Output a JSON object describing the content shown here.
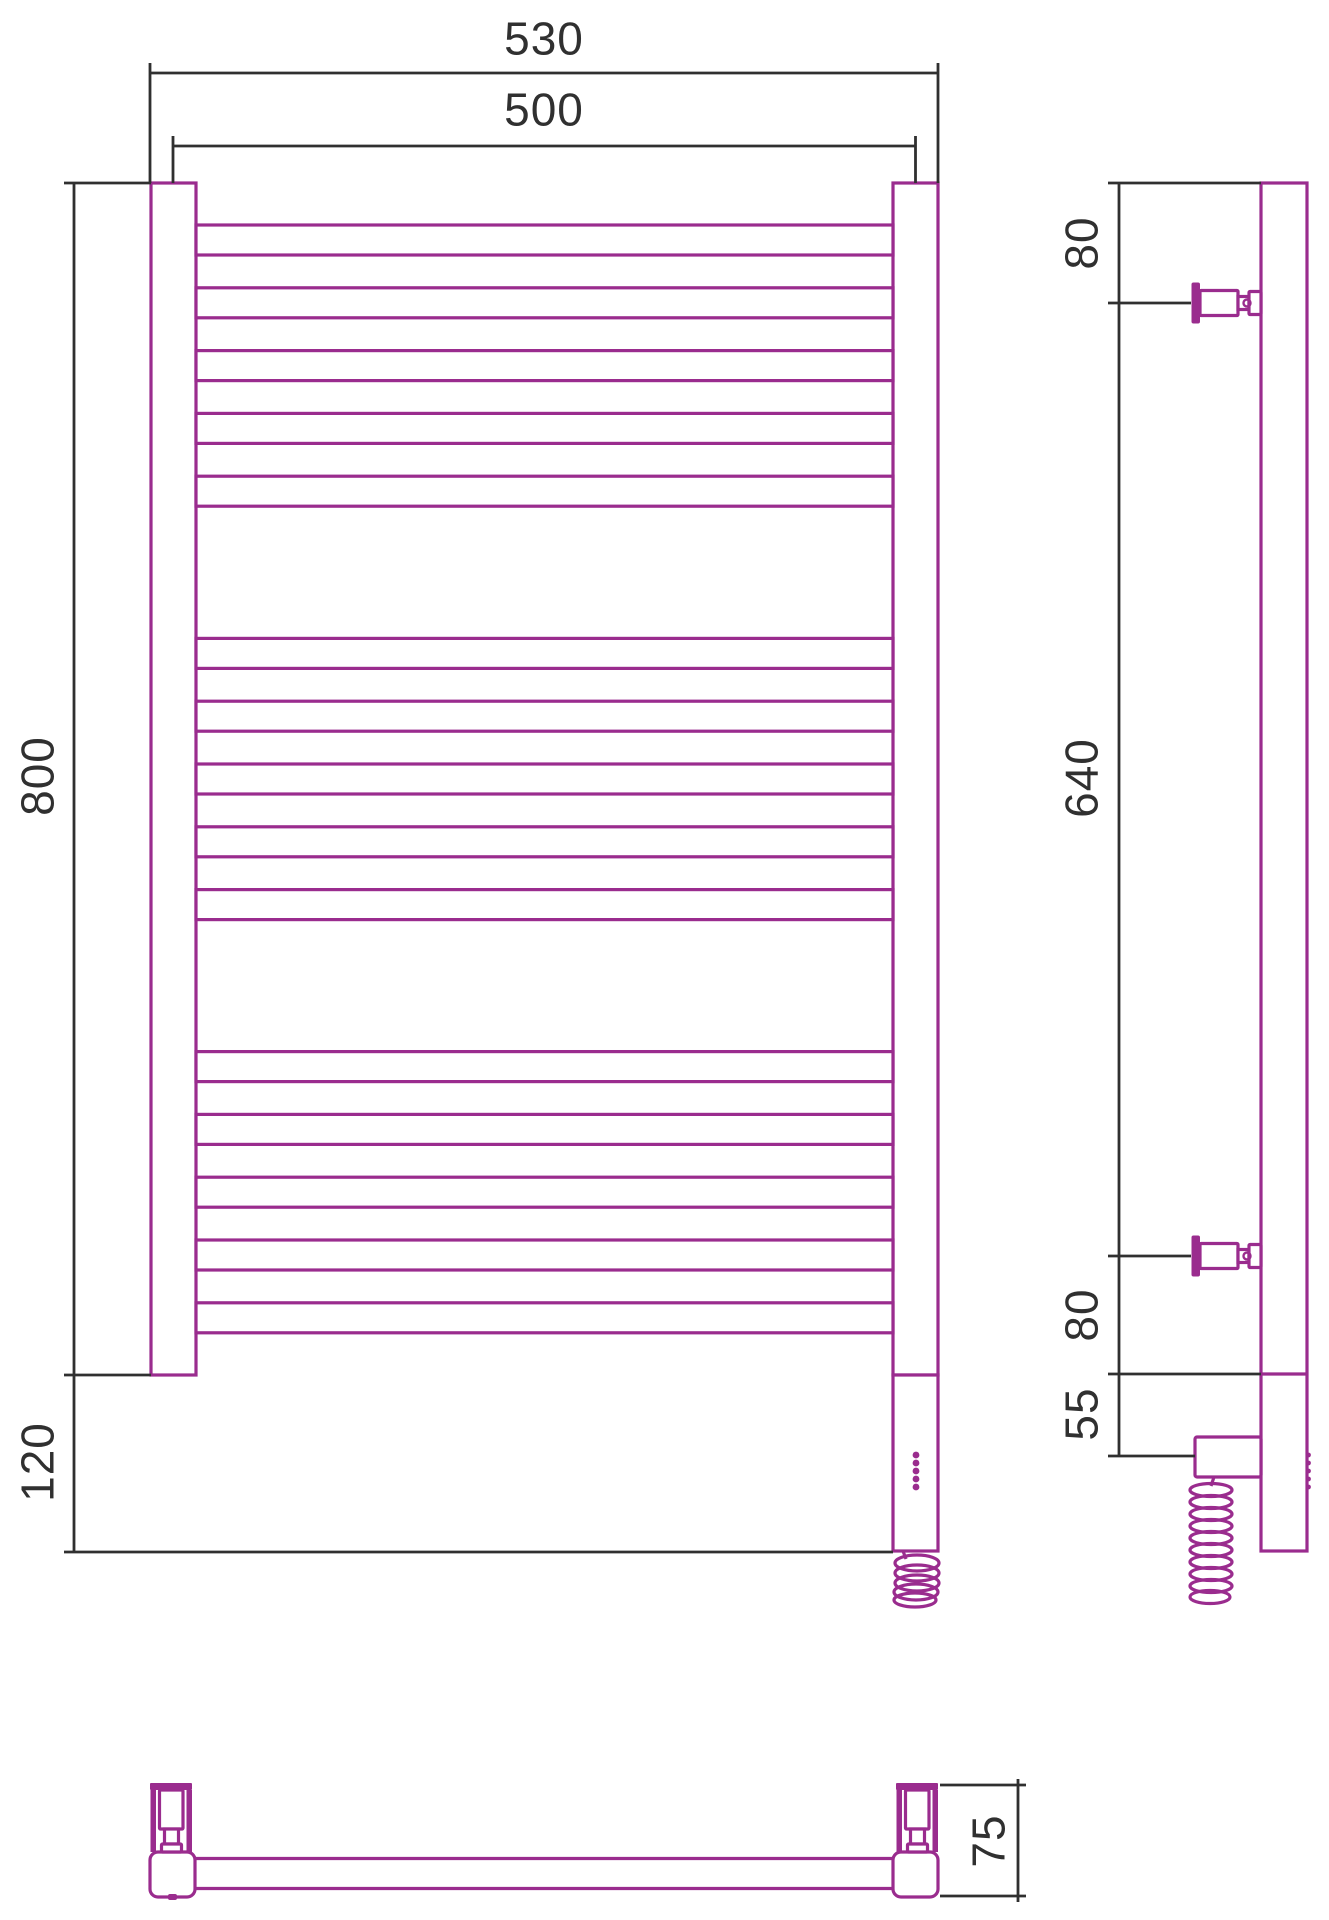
{
  "drawing": {
    "canvas": {
      "width": 1329,
      "height": 1920,
      "background": "#ffffff"
    },
    "colors": {
      "product": "#9A2C8E",
      "dimension": "#303030",
      "fill": "#ffffff"
    },
    "stroke_widths": {
      "product": 3.2,
      "thin": 2.8,
      "dimension": 2.8
    },
    "font": {
      "size": 46,
      "color": "#303030"
    },
    "crossbars": {
      "x": 196,
      "w": 697,
      "h": 30,
      "tops": [
        225,
        287.8,
        350.6,
        413.4,
        476.2,
        638.4,
        701.2,
        764,
        826.8,
        889.6,
        1051.6,
        1114.4,
        1177.2,
        1240,
        1302.8
      ]
    },
    "outlined_rects": [
      {
        "name": "front-left-rail",
        "x": 151,
        "y": 183,
        "w": 45,
        "h": 1192,
        "rx": 0
      },
      {
        "name": "front-right-rail",
        "x": 893,
        "y": 183,
        "w": 45,
        "h": 1192,
        "rx": 0
      },
      {
        "name": "front-heater-housing",
        "x": 893,
        "y": 1375,
        "w": 45,
        "h": 176,
        "rx": 0
      },
      {
        "name": "side-tube",
        "x": 1261,
        "y": 183,
        "w": 46,
        "h": 1368,
        "rx": 0
      },
      {
        "name": "side-electric-box",
        "x": 1195,
        "y": 1437,
        "w": 66,
        "h": 40,
        "rx": 2
      },
      {
        "name": "side-bracket-top-housing",
        "x": 1200,
        "y": 290.5,
        "w": 38,
        "h": 25,
        "rx": 1
      },
      {
        "name": "side-bracket-top-neck",
        "x": 1238,
        "y": 296.5,
        "w": 11,
        "h": 13,
        "rx": 0
      },
      {
        "name": "side-bracket-top-cap",
        "x": 1249,
        "y": 291.5,
        "w": 12,
        "h": 23,
        "rx": 1
      },
      {
        "name": "side-bracket-bottom-housing",
        "x": 1200,
        "y": 1243.5,
        "w": 38,
        "h": 25,
        "rx": 1
      },
      {
        "name": "side-bracket-bottom-neck",
        "x": 1238,
        "y": 1249.5,
        "w": 11,
        "h": 13,
        "rx": 0
      },
      {
        "name": "side-bracket-bottom-cap",
        "x": 1249,
        "y": 1244.5,
        "w": 12,
        "h": 23,
        "rx": 1
      },
      {
        "name": "bottom-left-corner-block",
        "x": 150,
        "y": 1852,
        "w": 45,
        "h": 45,
        "rx": 8
      },
      {
        "name": "bottom-right-corner-block",
        "x": 893,
        "y": 1852,
        "w": 45,
        "h": 45,
        "rx": 8
      },
      {
        "name": "bottom-left-bracket-cylinder",
        "x": 159.5,
        "y": 1790,
        "w": 23.5,
        "h": 39,
        "rx": 1
      },
      {
        "name": "bottom-left-bracket-stem",
        "x": 164.5,
        "y": 1829,
        "w": 14,
        "h": 15,
        "rx": 0
      },
      {
        "name": "bottom-left-bracket-flange",
        "x": 161.5,
        "y": 1844,
        "w": 20,
        "h": 8,
        "rx": 1
      },
      {
        "name": "bottom-right-bracket-cylinder",
        "x": 905.5,
        "y": 1790,
        "w": 23.5,
        "h": 39,
        "rx": 1
      },
      {
        "name": "bottom-right-bracket-stem",
        "x": 910.5,
        "y": 1829,
        "w": 14,
        "h": 15,
        "rx": 0
      },
      {
        "name": "bottom-right-bracket-flange",
        "x": 907.5,
        "y": 1844,
        "w": 20,
        "h": 8,
        "rx": 1
      }
    ],
    "filled_rects": [
      {
        "name": "side-bracket-top-wall-flange",
        "x": 1191.5,
        "y": 282.5,
        "w": 8.5,
        "h": 41,
        "rx": 2
      },
      {
        "name": "side-bracket-bottom-wall-flange",
        "x": 1191.5,
        "y": 1235.5,
        "w": 8.5,
        "h": 41,
        "rx": 2
      },
      {
        "name": "bottom-left-wall-plate",
        "x": 150,
        "y": 1783,
        "w": 42,
        "h": 7,
        "rx": 1
      },
      {
        "name": "bottom-right-wall-plate",
        "x": 896,
        "y": 1783,
        "w": 42,
        "h": 7,
        "rx": 1
      },
      {
        "name": "bottom-left-bracket-wall-a",
        "x": 150.5,
        "y": 1790,
        "w": 5.5,
        "h": 62,
        "rx": 0
      },
      {
        "name": "bottom-left-bracket-wall-b",
        "x": 186.5,
        "y": 1790,
        "w": 5.5,
        "h": 62,
        "rx": 0
      },
      {
        "name": "bottom-right-bracket-wall-a",
        "x": 896.5,
        "y": 1790,
        "w": 5.5,
        "h": 62,
        "rx": 0
      },
      {
        "name": "bottom-right-bracket-wall-b",
        "x": 932.5,
        "y": 1790,
        "w": 5.5,
        "h": 62,
        "rx": 0
      },
      {
        "name": "bottom-left-block-notch",
        "x": 168,
        "y": 1894,
        "w": 9,
        "h": 6,
        "rx": 2
      }
    ],
    "product_lines": [
      {
        "name": "side-tube-joint",
        "x1": 1261,
        "y1": 1374,
        "x2": 1307,
        "y2": 1374
      },
      {
        "name": "bottom-tube-top-edge",
        "x1": 195,
        "y1": 1858.5,
        "x2": 893,
        "y2": 1858.5
      },
      {
        "name": "bottom-tube-bottom-edge",
        "x1": 195,
        "y1": 1888.5,
        "x2": 893,
        "y2": 1888.5
      },
      {
        "name": "front-spiral-neck",
        "x1": 903,
        "y1": 1551,
        "x2": 906,
        "y2": 1559
      },
      {
        "name": "side-spiral-neck",
        "x1": 1214,
        "y1": 1477,
        "x2": 1211,
        "y2": 1486
      }
    ],
    "spiral_ellipses": [
      {
        "name": "front-cable-coil",
        "cx": 917,
        "cy": 1563,
        "rx": 22,
        "ry": 8
      },
      {
        "name": "front-cable-coil",
        "cx": 917,
        "cy": 1573,
        "rx": 22,
        "ry": 8
      },
      {
        "name": "front-cable-coil",
        "cx": 917,
        "cy": 1583,
        "rx": 22,
        "ry": 8
      },
      {
        "name": "front-cable-coil",
        "cx": 916,
        "cy": 1592,
        "rx": 22,
        "ry": 8
      },
      {
        "name": "front-cable-coil",
        "cx": 915,
        "cy": 1600,
        "rx": 21,
        "ry": 7
      },
      {
        "name": "side-cable-coil",
        "cx": 1211,
        "cy": 1490,
        "rx": 21,
        "ry": 6.5
      },
      {
        "name": "side-cable-coil",
        "cx": 1211,
        "cy": 1502,
        "rx": 21,
        "ry": 6.5
      },
      {
        "name": "side-cable-coil",
        "cx": 1211,
        "cy": 1514,
        "rx": 21,
        "ry": 6.5
      },
      {
        "name": "side-cable-coil",
        "cx": 1211,
        "cy": 1526,
        "rx": 21,
        "ry": 6.5
      },
      {
        "name": "side-cable-coil",
        "cx": 1211,
        "cy": 1538,
        "rx": 21,
        "ry": 6.5
      },
      {
        "name": "side-cable-coil",
        "cx": 1211,
        "cy": 1550,
        "rx": 21,
        "ry": 6.5
      },
      {
        "name": "side-cable-coil",
        "cx": 1211,
        "cy": 1562,
        "rx": 21,
        "ry": 6.5
      },
      {
        "name": "side-cable-coil",
        "cx": 1211,
        "cy": 1574,
        "rx": 21,
        "ry": 6.5
      },
      {
        "name": "side-cable-coil",
        "cx": 1211,
        "cy": 1586,
        "rx": 21,
        "ry": 6.5
      },
      {
        "name": "side-cable-coil",
        "cx": 1210,
        "cy": 1597,
        "rx": 20,
        "ry": 6.5
      }
    ],
    "stroked_circles": [
      {
        "name": "side-bracket-top-screw",
        "cx": 1247,
        "cy": 303,
        "r": 3.5
      },
      {
        "name": "side-bracket-bottom-screw",
        "cx": 1247,
        "cy": 1256,
        "r": 3.5
      }
    ],
    "filled_dots": [
      {
        "name": "front-indicator-dot",
        "cx": 916,
        "cy": 1455,
        "r": 3.4
      },
      {
        "name": "front-indicator-dot",
        "cx": 916,
        "cy": 1463,
        "r": 3.4
      },
      {
        "name": "front-indicator-dot",
        "cx": 916,
        "cy": 1471,
        "r": 3.4
      },
      {
        "name": "front-indicator-dot",
        "cx": 916,
        "cy": 1479,
        "r": 3.4
      },
      {
        "name": "front-indicator-dot",
        "cx": 916,
        "cy": 1487,
        "r": 3.4
      },
      {
        "name": "side-indicator-bump",
        "cx": 1308.5,
        "cy": 1455,
        "r": 2.4
      },
      {
        "name": "side-indicator-bump",
        "cx": 1308.5,
        "cy": 1463,
        "r": 2.4
      },
      {
        "name": "side-indicator-bump",
        "cx": 1308.5,
        "cy": 1471,
        "r": 2.4
      },
      {
        "name": "side-indicator-bump",
        "cx": 1308.5,
        "cy": 1479,
        "r": 2.4
      },
      {
        "name": "side-indicator-bump",
        "cx": 1308.5,
        "cy": 1487,
        "r": 2.4
      }
    ],
    "dimension_lines": [
      {
        "name": "dim-530-line",
        "x1": 150,
        "y1": 73,
        "x2": 938,
        "y2": 73
      },
      {
        "name": "dim-530-ext-left",
        "x1": 150,
        "y1": 63,
        "x2": 150,
        "y2": 183
      },
      {
        "name": "dim-530-ext-right",
        "x1": 938,
        "y1": 63,
        "x2": 938,
        "y2": 183
      },
      {
        "name": "dim-500-line",
        "x1": 173,
        "y1": 146,
        "x2": 915.5,
        "y2": 146
      },
      {
        "name": "dim-500-ext-left",
        "x1": 173,
        "y1": 136,
        "x2": 173,
        "y2": 183
      },
      {
        "name": "dim-500-ext-right",
        "x1": 915.5,
        "y1": 136,
        "x2": 915.5,
        "y2": 183
      },
      {
        "name": "dim-800-line",
        "x1": 74,
        "y1": 183,
        "x2": 74,
        "y2": 1375
      },
      {
        "name": "dim-800-ext-top",
        "x1": 64,
        "y1": 183,
        "x2": 151,
        "y2": 183
      },
      {
        "name": "dim-800-ext-bottom",
        "x1": 64,
        "y1": 1375,
        "x2": 151,
        "y2": 1375
      },
      {
        "name": "dim-120-line",
        "x1": 74,
        "y1": 1375,
        "x2": 74,
        "y2": 1552
      },
      {
        "name": "dim-120-ext-bottom",
        "x1": 64,
        "y1": 1552,
        "x2": 893,
        "y2": 1552
      },
      {
        "name": "side-dim-line",
        "x1": 1119,
        "y1": 183,
        "x2": 1119,
        "y2": 1456
      },
      {
        "name": "side-ext-tube-top",
        "x1": 1108,
        "y1": 183,
        "x2": 1261,
        "y2": 183
      },
      {
        "name": "side-ext-bracket-top",
        "x1": 1108,
        "y1": 303,
        "x2": 1191,
        "y2": 303
      },
      {
        "name": "side-ext-bracket-bottom",
        "x1": 1108,
        "y1": 1256,
        "x2": 1191,
        "y2": 1256
      },
      {
        "name": "side-ext-rail-bottom",
        "x1": 1108,
        "y1": 1374,
        "x2": 1261,
        "y2": 1374
      },
      {
        "name": "side-ext-box-bottom",
        "x1": 1108,
        "y1": 1456,
        "x2": 1195,
        "y2": 1456
      },
      {
        "name": "dim-75-ext-top",
        "x1": 940,
        "y1": 1785,
        "x2": 1026,
        "y2": 1785
      },
      {
        "name": "dim-75-ext-bottom",
        "x1": 940,
        "y1": 1896,
        "x2": 1026,
        "y2": 1896
      },
      {
        "name": "dim-75-line",
        "x1": 1018,
        "y1": 1779,
        "x2": 1018,
        "y2": 1902
      }
    ],
    "dimension_labels": [
      {
        "name": "dim-label-530",
        "text": "530",
        "x": 544,
        "y": 38,
        "rotate": 0
      },
      {
        "name": "dim-label-500",
        "text": "500",
        "x": 544,
        "y": 109,
        "rotate": 0
      },
      {
        "name": "dim-label-800",
        "text": "800",
        "x": 37,
        "y": 776,
        "rotate": -90
      },
      {
        "name": "dim-label-120",
        "text": "120",
        "x": 37,
        "y": 1462,
        "rotate": -90
      },
      {
        "name": "dim-label-80-top",
        "text": "80",
        "x": 1081,
        "y": 243,
        "rotate": -90
      },
      {
        "name": "dim-label-640",
        "text": "640",
        "x": 1081,
        "y": 778,
        "rotate": -90
      },
      {
        "name": "dim-label-80-bottom",
        "text": "80",
        "x": 1081,
        "y": 1315,
        "rotate": -90
      },
      {
        "name": "dim-label-55",
        "text": "55",
        "x": 1081,
        "y": 1414,
        "rotate": -90
      },
      {
        "name": "dim-label-75",
        "text": "75",
        "x": 988,
        "y": 1841,
        "rotate": -90
      }
    ]
  }
}
